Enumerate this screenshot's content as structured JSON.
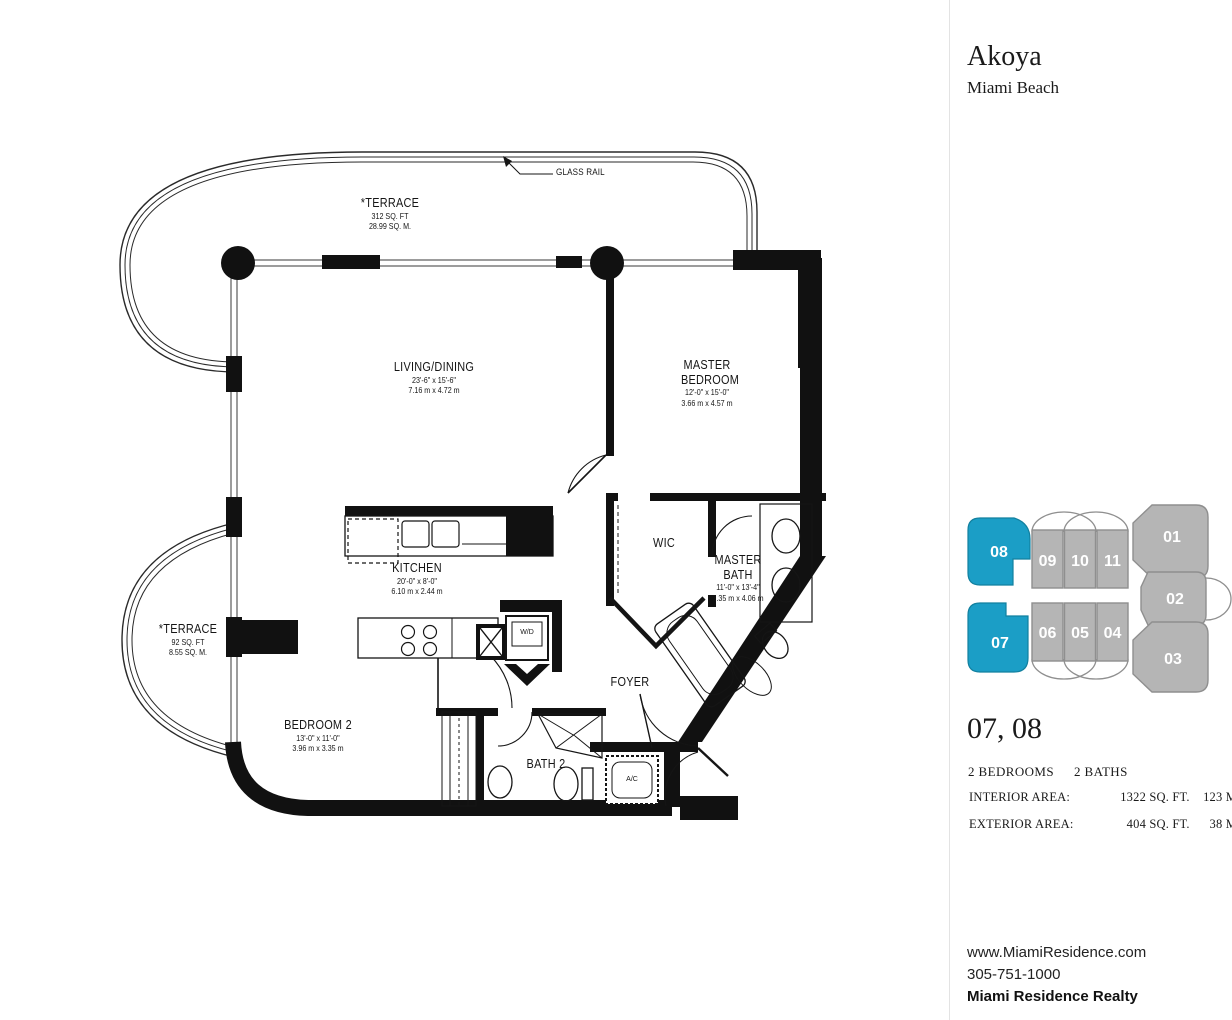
{
  "header": {
    "title": "Akoya",
    "subtitle": "Miami Beach"
  },
  "floorplan": {
    "glass_rail_label": "GLASS RAIL",
    "rooms": {
      "terrace_top": {
        "name": "*TERRACE",
        "dim1": "312 SQ. FT",
        "dim2": "28.99 SQ. M."
      },
      "living": {
        "name": "LIVING/DINING",
        "dim1": "23'-6\" x 15'-6\"",
        "dim2": "7.16 m x 4.72 m"
      },
      "master_bedroom": {
        "name": "MASTER BEDROOM",
        "dim1": "12'-0\" x 15'-0\"",
        "dim2": "3.66 m x 4.57 m"
      },
      "kitchen": {
        "name": "KITCHEN",
        "dim1": "20'-0\" x 8'-0\"",
        "dim2": "6.10 m x 2.44 m"
      },
      "wic": {
        "name": "WIC"
      },
      "master_bath": {
        "name": "MASTER BATH",
        "dim1": "11'-0\" x 13'-4\"",
        "dim2": "3.35 m x 4.06 m"
      },
      "terrace_lower": {
        "name": "*TERRACE",
        "dim1": "92 SQ. FT",
        "dim2": "8.55 SQ. M."
      },
      "bedroom_2": {
        "name": "BEDROOM 2",
        "dim1": "13'-0\" x 11'-0\"",
        "dim2": "3.96 m x 3.35 m"
      },
      "bath_2": {
        "name": "BATH 2"
      },
      "foyer": {
        "name": "FOYER"
      },
      "washer_dryer": {
        "name": "W/D"
      },
      "ac": {
        "name": "A/C"
      }
    }
  },
  "keyplan": {
    "highlight_color": "#1b9ec6",
    "gray_color": "#b5b5b5",
    "outline_color": "#8f8f8f",
    "highlighted_units": [
      "07",
      "08"
    ],
    "units": {
      "u01": "01",
      "u02": "02",
      "u03": "03",
      "u04": "04",
      "u05": "05",
      "u06": "06",
      "u07": "07",
      "u08": "08",
      "u09": "09",
      "u10": "10",
      "u11": "11"
    }
  },
  "unit_info": {
    "units_label": "07, 08",
    "bedrooms": "2 BEDROOMS",
    "baths": "2 BATHS",
    "interior": {
      "label": "INTERIOR AREA:",
      "sqft": "1322 SQ. FT.",
      "sqm": "123 M²"
    },
    "exterior": {
      "label": "EXTERIOR AREA:",
      "sqft": "404 SQ. FT.",
      "sqm": "38 M²"
    }
  },
  "contact": {
    "website": "www.MiamiResidence.com",
    "phone": "305-751-1000",
    "company": "Miami Residence Realty"
  }
}
